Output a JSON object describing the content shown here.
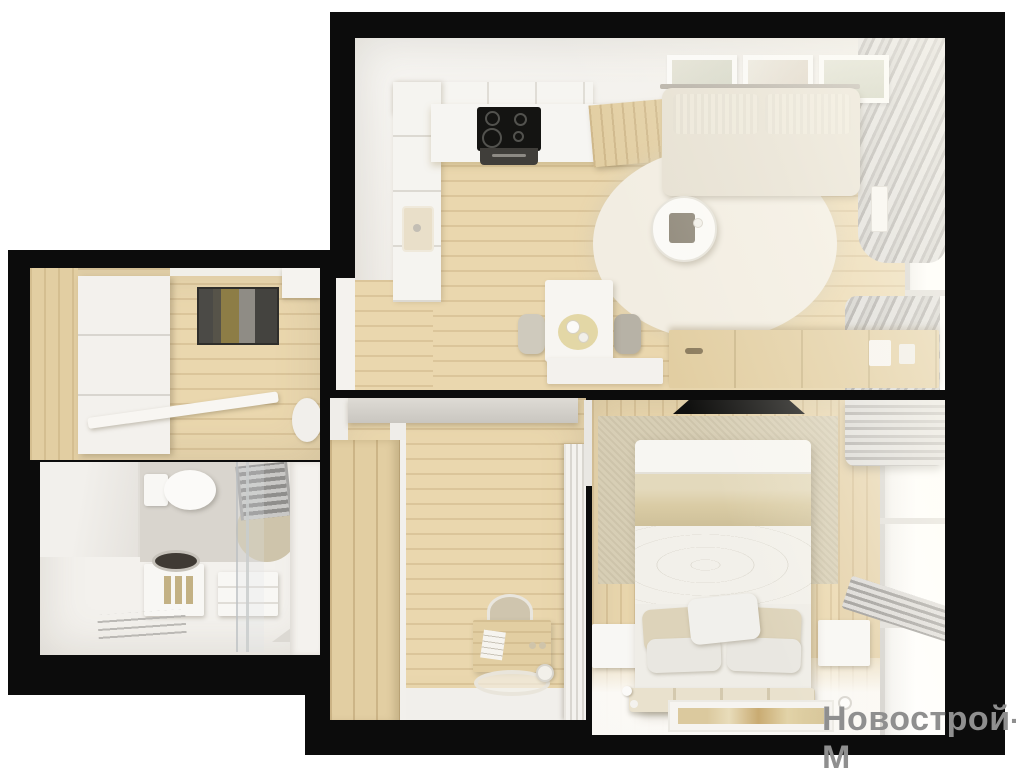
{
  "watermark": {
    "text": "Новострой-М"
  },
  "palette": {
    "page_bg": "#ffffff",
    "mask": "#0c0c0c",
    "wall": "#efece7",
    "wall_bright": "#f7f6f3",
    "wood": "#ead7ae",
    "wood_dark": "#d9c193",
    "wood_warm": "#e2cea2",
    "rug": "#f2ede2",
    "sofa": "#e6e0d2",
    "cushion": "#ece7d9",
    "curtain_light": "#dddcda",
    "curtain_mid": "#b3b1af",
    "curtain_dark": "#a8a6a4",
    "tile": "#d9d5ce",
    "accent_panel": "#d7ceb5",
    "blanket": "#dacca5",
    "pillow_beige": "#ddd3ba",
    "doormat_dark": "#4b4a46",
    "doormat_olive": "#8d7d46",
    "doormat_gray": "#8f8c85",
    "cooktop": "#141412",
    "watermark": "#8f8f8f"
  },
  "legend": {
    "type": "apartment-floorplan-3d-render",
    "rooms": [
      {
        "id": "living-room-kitchen",
        "furniture": [
          "kitchen-cabinets",
          "cooktop",
          "oven",
          "sink",
          "wood-worktop",
          "wall-art-frames",
          "sofa",
          "round-rug",
          "coffee-table",
          "dining-table",
          "dining-chairs",
          "bench",
          "tv-console",
          "curtains",
          "window",
          "radiator"
        ]
      },
      {
        "id": "hallway",
        "furniture": [
          "wardrobe",
          "doormat",
          "open-door"
        ]
      },
      {
        "id": "bathroom",
        "furniture": [
          "toilet",
          "towel-radiator",
          "vanity-sink",
          "washing-machine",
          "shower-glass",
          "drying-rack"
        ]
      },
      {
        "id": "nursery-office",
        "furniture": [
          "wardrobe",
          "wall-console",
          "desk",
          "chair",
          "round-rug",
          "floor-lamp",
          "slatted-door"
        ]
      },
      {
        "id": "bedroom",
        "furniture": [
          "bed",
          "pillows",
          "headboard-bench",
          "nightstands",
          "wall-tv",
          "accent-rug-panel",
          "roman-blind",
          "radiator",
          "window",
          "floor-rug"
        ]
      }
    ]
  }
}
